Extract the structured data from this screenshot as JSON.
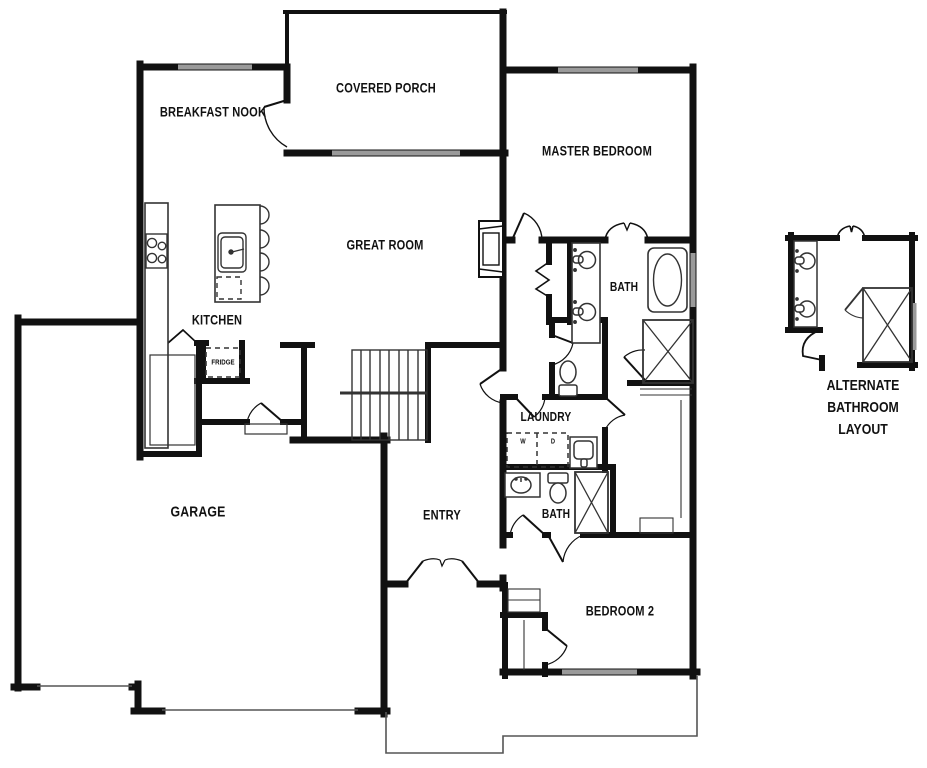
{
  "plan": {
    "type": "single-family home first floor plan",
    "rooms": {
      "breakfast_nook": "BREAKFAST NOOK",
      "covered_porch": "COVERED PORCH",
      "master_bedroom": "MASTER BEDROOM",
      "great_room": "GREAT ROOM",
      "kitchen": "KITCHEN",
      "master_bath": "BATH",
      "laundry": "LAUNDRY",
      "bath2": "BATH",
      "entry": "ENTRY",
      "garage": "GARAGE",
      "bedroom2": "BEDROOM 2"
    },
    "appliances": {
      "fridge": "FRIDGE",
      "washer": "W",
      "dryer": "D"
    },
    "inset": {
      "alt_bath_line1": "ALTERNATE",
      "alt_bath_line2": "BATHROOM",
      "alt_bath_line3": "LAYOUT"
    },
    "colors": {
      "wall": "#111111",
      "window": "#9a9a9a",
      "fixture_line": "#333333",
      "background": "#ffffff"
    }
  }
}
